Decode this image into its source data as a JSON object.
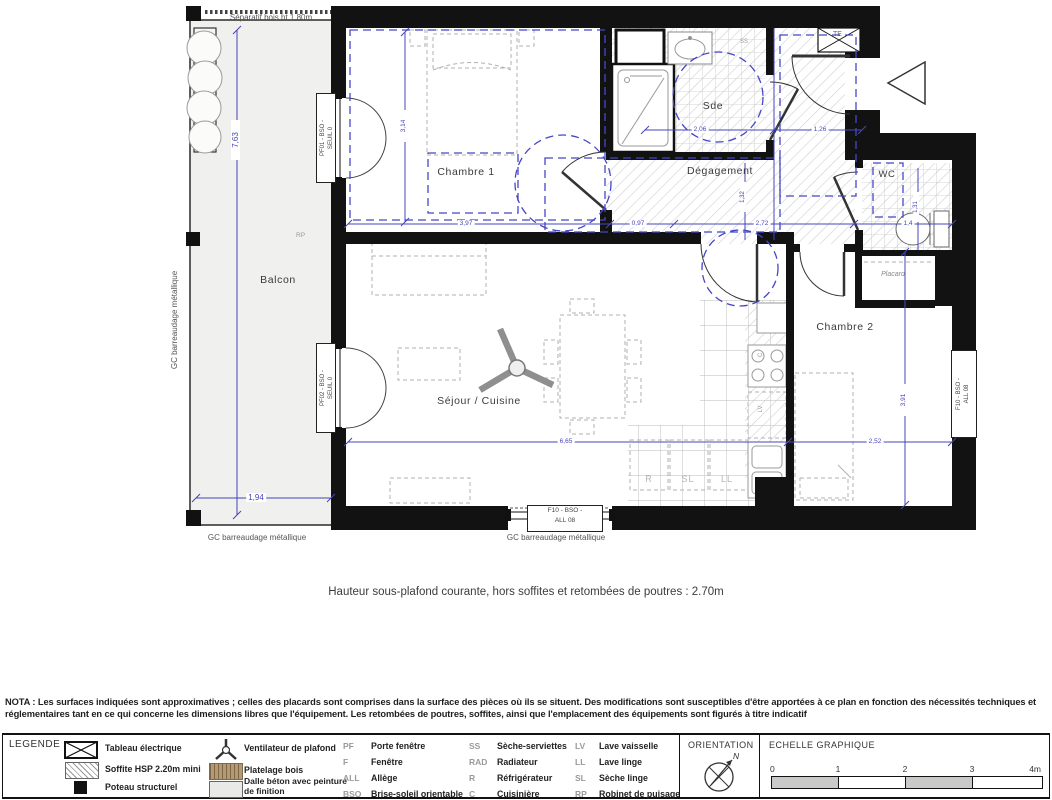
{
  "plan": {
    "separator_note": "Séparatif bois ht 1.80m",
    "rooms": {
      "balcon": "Balcon",
      "chambre1": "Chambre 1",
      "sde": "Sde",
      "degagement": "Dégagement",
      "wc": "WC",
      "placard": "Placard",
      "chambre2": "Chambre 2",
      "sejour_cuisine": "Séjour / Cuisine"
    },
    "guardrails": {
      "left": "GC barreaudage métallique",
      "bottom_left": "GC barreaudage métallique",
      "bottom_center": "GC barreaudage métallique"
    },
    "windows": {
      "pf01_line1": "PF01 - BSO -",
      "pf01_line2": "SEUIL 0",
      "pf02_line1": "PF02 - BSO -",
      "pf02_line2": "SEUIL 0",
      "f10_line1": "F10 - BSO -",
      "f10_line2": "ALL 08"
    },
    "dimensions": {
      "balcony_height": "7,63",
      "balcony_width": "1,94",
      "chambre1_width": "3,97",
      "chambre1_height": "3,14",
      "between": "0,97",
      "degagement_width": "2,72",
      "degagement_height": "1,32",
      "sde_width": "2,06",
      "entry_width": "1,26",
      "wc_width": "1,4",
      "wc_height": "1,31",
      "sejour_width": "6,65",
      "chambre2_width": "2,52",
      "chambre2_height": "3,91"
    },
    "tags": {
      "rp": "RP",
      "te": "TE",
      "ss": "SS",
      "c": "C",
      "lv": "LV",
      "r": "R",
      "sl": "SL",
      "ll": "LL"
    },
    "caption": "Hauteur sous-plafond courante, hors soffites et retombées de poutres : 2.70m"
  },
  "nota": "NOTA : Les surfaces indiquées sont approximatives ; celles des placards sont comprises dans la surface des pièces où ils se situent. Des modifications sont susceptibles d'être apportées à ce plan en fonction des nécessités techniques et réglementaires tant en ce qui concerne les dimensions libres que l'équipement. Les retombées de poutres, soffites, ainsi que l'emplacement des équipements sont figurés à titre indicatif",
  "legend": {
    "title": "LEGENDE",
    "symbols": [
      {
        "icon": "electrical-panel",
        "label": "Tableau électrique"
      },
      {
        "icon": "soffit-hatch",
        "label": "Soffite HSP 2.20m mini"
      },
      {
        "icon": "structural-post",
        "label": "Poteau structurel"
      },
      {
        "icon": "ceiling-fan",
        "label": "Ventilateur de plafond"
      },
      {
        "icon": "wood-decking",
        "label": "Platelage bois"
      },
      {
        "icon": "concrete-slab",
        "label": "Dalle béton avec peinture de finition"
      }
    ],
    "abbreviations": [
      {
        "abbr": "PF",
        "label": "Porte fenêtre"
      },
      {
        "abbr": "F",
        "label": "Fenêtre"
      },
      {
        "abbr": "ALL",
        "label": "Allège"
      },
      {
        "abbr": "BSO",
        "label": "Brise-soleil orientable"
      },
      {
        "abbr": "SS",
        "label": "Sèche-serviettes"
      },
      {
        "abbr": "RAD",
        "label": "Radiateur"
      },
      {
        "abbr": "R",
        "label": "Réfrigérateur"
      },
      {
        "abbr": "C",
        "label": "Cuisinière"
      },
      {
        "abbr": "LV",
        "label": "Lave vaisselle"
      },
      {
        "abbr": "LL",
        "label": "Lave linge"
      },
      {
        "abbr": "SL",
        "label": "Sèche linge"
      },
      {
        "abbr": "RP",
        "label": "Robinet de puisage"
      }
    ],
    "orientation": {
      "title": "ORIENTATION",
      "north": "N"
    },
    "scale": {
      "title": "ECHELLE GRAPHIQUE",
      "ticks": [
        "0",
        "1",
        "2",
        "3",
        "4m"
      ]
    }
  },
  "colors": {
    "wall": "#121212",
    "dimension_blue": "#4646bb",
    "hatch_gray": "#cfcfcf",
    "balcony_floor": "#f0f0ee",
    "wood_brown": "#b49a72",
    "scale_gray": "#c9c9c7"
  }
}
